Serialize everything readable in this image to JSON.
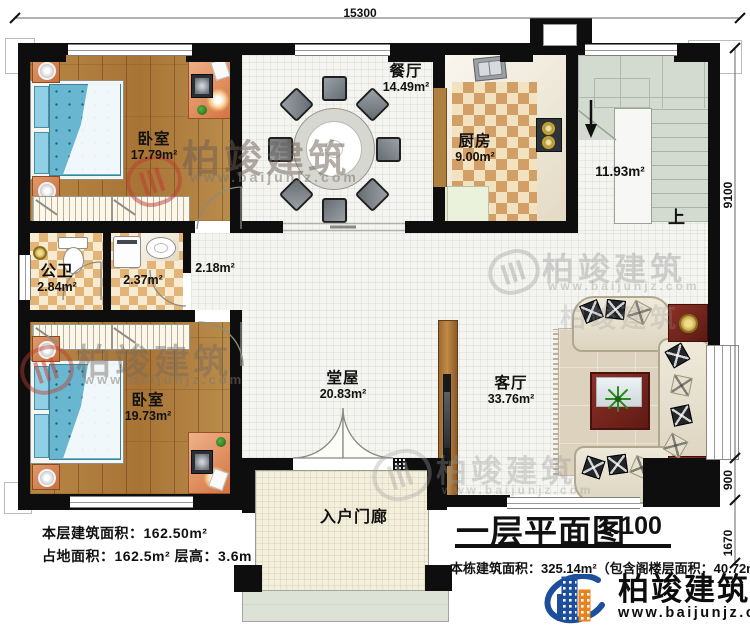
{
  "title_block": {
    "title": "一层平面图",
    "scale": "1:100",
    "building_area_note": "本栋建筑面积：325.14m²（包含阁楼层面积：40.72m²）"
  },
  "floor_stats": {
    "line1": "本层建筑面积：162.50m²",
    "line2": "占地面积：162.5m²  层高：3.6m"
  },
  "brand": {
    "name": "柏竣建筑",
    "url": "www.baijunjz.com"
  },
  "dimensions": {
    "top_width": "15300",
    "right_main": "9100",
    "right_offset": "900",
    "right_porch": "1670"
  },
  "rooms": {
    "bedroom1": {
      "name": "卧室",
      "area": "17.79m²"
    },
    "dining": {
      "name": "餐厅",
      "area": "14.49m²"
    },
    "kitchen": {
      "name": "厨房",
      "area": "9.00m²"
    },
    "stairwell": {
      "area": "11.93m²",
      "direction": "上"
    },
    "bathroom": {
      "name": "公卫",
      "area": "2.84m²"
    },
    "laundry": {
      "area": "2.37m²"
    },
    "corridor": {
      "area": "2.18m²"
    },
    "bedroom2": {
      "name": "卧室",
      "area": "19.73m²"
    },
    "hall": {
      "name": "堂屋",
      "area": "20.83m²"
    },
    "living": {
      "name": "客厅",
      "area": "33.76m²"
    },
    "porch": {
      "name": "入户门廊"
    }
  },
  "colors": {
    "wall": "#0e0e0e",
    "wood_floor": "#b08040",
    "tile": "#f4f4f1",
    "checker_dark": "#d2a066",
    "checker_light": "#f2e2bf",
    "mattress_blue": "#68b6cf",
    "accent_red": "#7a2320",
    "brand_blue": "#1d4e9b",
    "brand_orange": "#e8821e"
  }
}
